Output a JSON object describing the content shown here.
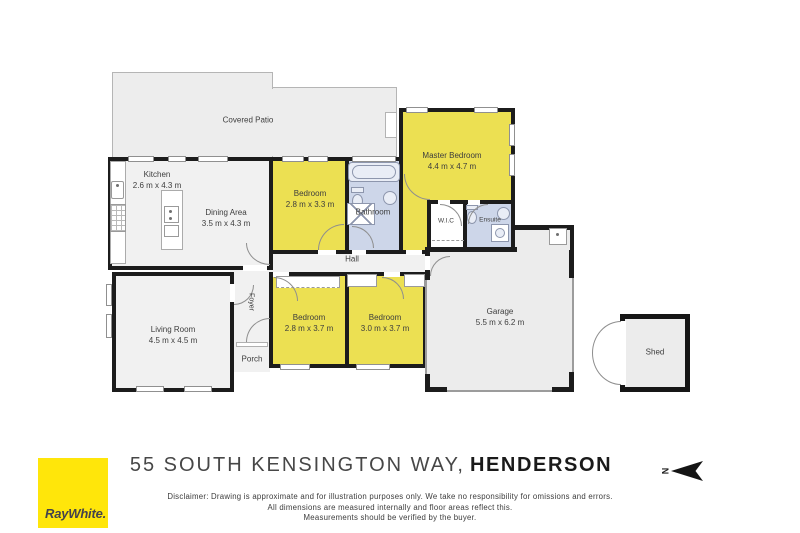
{
  "palette": {
    "wall": "#1c1c1c",
    "room_gray": "#f1f1f1",
    "room_yellow": "#ece052",
    "room_blue": "#cdd6e9",
    "outdoor_gray": "#ededed",
    "label_text": "#3d3d3d",
    "logo_yellow": "#ffe60a",
    "logo_text": "#43434d"
  },
  "rooms": [
    {
      "name": "Covered Patio",
      "dims": ""
    },
    {
      "name": "Kitchen",
      "dims": "2.6 m x 4.3 m"
    },
    {
      "name": "Dining Area",
      "dims": "3.5 m x 4.3 m"
    },
    {
      "name": "Bedroom",
      "dims": "2.8 m x 3.3 m"
    },
    {
      "name": "Bathroom",
      "dims": ""
    },
    {
      "name": "Master Bedroom",
      "dims": "4.4 m x 4.7 m"
    },
    {
      "name": "W.I.C",
      "dims": ""
    },
    {
      "name": "Ensuite",
      "dims": ""
    },
    {
      "name": "Hall",
      "dims": ""
    },
    {
      "name": "Living Room",
      "dims": "4.5 m x 4.5 m"
    },
    {
      "name": "Foyer",
      "dims": ""
    },
    {
      "name": "Porch",
      "dims": ""
    },
    {
      "name": "Bedroom",
      "dims": "2.8 m x 3.7 m"
    },
    {
      "name": "Bedroom",
      "dims": "3.0 m x 3.7 m"
    },
    {
      "name": "Garage",
      "dims": "5.5 m x 6.2 m"
    },
    {
      "name": "Shed",
      "dims": ""
    }
  ],
  "title": {
    "street": "55 SOUTH KENSINGTON WAY,",
    "suburb": "HENDERSON"
  },
  "compass": {
    "north_letter": "N"
  },
  "branding": {
    "logo_text": "RayWhite."
  },
  "disclaimer": {
    "line1": "Disclaimer: Drawing is approximate and for illustration purposes only. We take no responsibility for omissions and errors.",
    "line2": "All dimensions are measured internally and floor areas reflect this.",
    "line3": "Measurements should be verified by the buyer."
  }
}
